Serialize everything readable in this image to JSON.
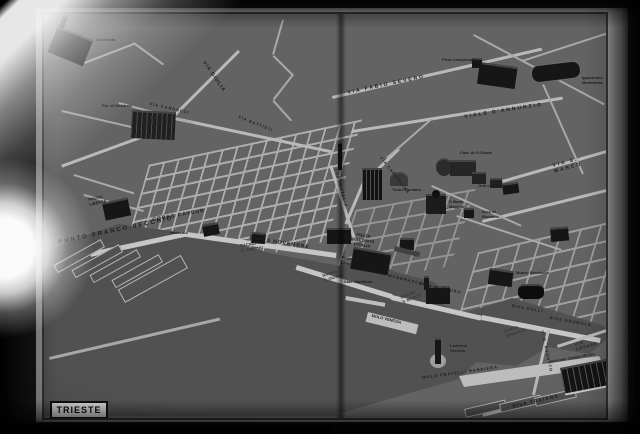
{
  "map": {
    "title": "TRIESTE",
    "colors": {
      "land_gray": "#636363",
      "water_gray": "#515151",
      "street_light": "#b9b9b9",
      "building_dark": "#161616",
      "label_dark": "#1d1d1d"
    },
    "labels": [
      {
        "text": "Università"
      },
      {
        "text": "Pal. di Giustizia"
      },
      {
        "text": "Fiera Campionaria"
      },
      {
        "text": "Ippodromo Montebello"
      },
      {
        "text": "VIA FABIO SEVERO"
      },
      {
        "text": "VIALE D'ANNUNZIO"
      },
      {
        "text": "VIA GIULIA"
      },
      {
        "text": "VIA CARDUCCI"
      },
      {
        "text": "VIA BATTISTI"
      },
      {
        "text": "VIA S. MARCO"
      },
      {
        "text": "Cast. di S.Giusto"
      },
      {
        "text": "Teatro Romano"
      },
      {
        "text": "S.Maria\nMaggiore"
      },
      {
        "text": "Orto Lapidario"
      },
      {
        "text": "Arco di\nRiccardo"
      },
      {
        "text": "VIA CAPITOLINA"
      },
      {
        "text": "CORSO ITALIA"
      },
      {
        "text": "PIAZZA\nLIBERTÀ"
      },
      {
        "text": "CORSO CAVOUR"
      },
      {
        "text": "PUNTO FRANCO VECCHIO"
      },
      {
        "text": "RIVA 3 NOVEMBRE"
      },
      {
        "text": "BACINO\nS. GIORGIO"
      },
      {
        "text": "Idroscalo"
      },
      {
        "text": "PIAZZA\nDELL'UNITÀ\nD'ITALIA"
      },
      {
        "text": "Palazzo\nLloyd"
      },
      {
        "text": "RIVA MANDRACCHIO"
      },
      {
        "text": "Staz. Marittima"
      },
      {
        "text": "BACINO\nS. GIUSTO"
      },
      {
        "text": "RIVA N. SAURO"
      },
      {
        "text": "BACINO\nS. MARCO"
      },
      {
        "text": "MOLO VENEZIA"
      },
      {
        "text": "Museo Revoltella"
      },
      {
        "text": "RIVA GULLI"
      },
      {
        "text": "RIVA GRUMULA"
      },
      {
        "text": "PORTO\nSPORTIVO"
      },
      {
        "text": "Lanterna\nVecchia"
      },
      {
        "text": "MOLO FRATELLI BANDIERA"
      },
      {
        "text": "V. O. AUGUSTO"
      },
      {
        "text": "VIA CESARE"
      },
      {
        "text": "Stazione Campo Marzio"
      },
      {
        "text": "RIVA TRAIANA"
      }
    ]
  }
}
